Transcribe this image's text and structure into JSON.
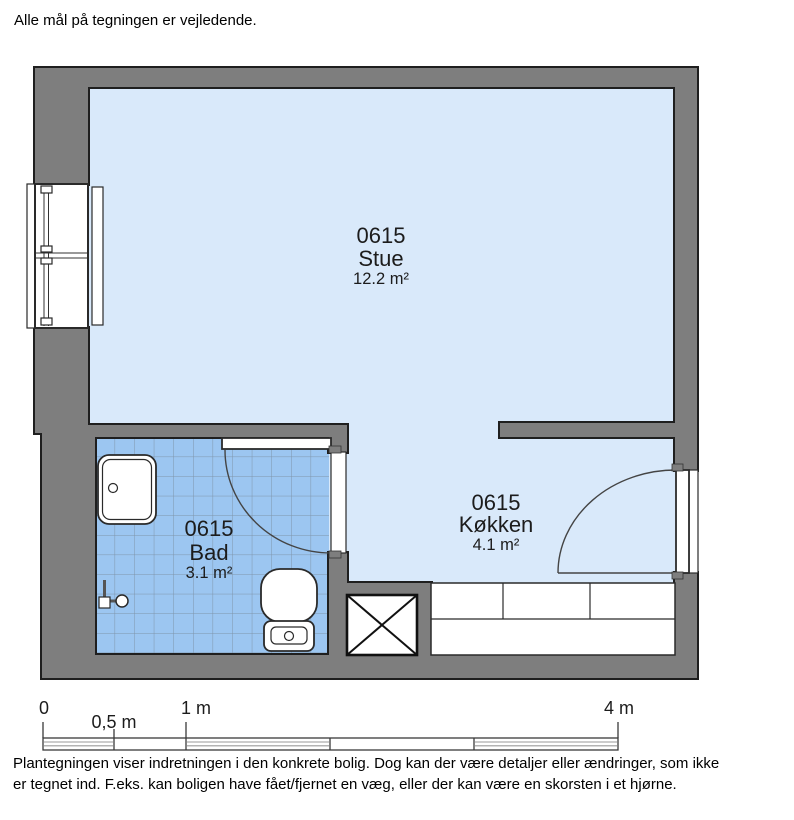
{
  "notes": {
    "top": "Alle mål på tegningen er vejledende.",
    "bottom_line1": "Plantegningen viser indretningen i den konkrete bolig. Dog kan der være detaljer eller ændringer, som ikke",
    "bottom_line2": "er tegnet ind. F.eks. kan boligen have fået/fjernet en væg, eller der kan være en skorsten i et hjørne."
  },
  "floor_plan": {
    "rooms": {
      "stue": {
        "id": "0615",
        "name": "Stue",
        "area": "12.2 m²"
      },
      "bad": {
        "id": "0615",
        "name": "Bad",
        "area": "3.1 m²"
      },
      "kokken": {
        "id": "0615",
        "name": "Køkken",
        "area": "4.1 m²"
      }
    },
    "fixtures": [
      "window",
      "radiator",
      "shower-tray",
      "faucet",
      "toilet",
      "door-swing-bad",
      "door-swing-kokken",
      "vent-shaft",
      "kitchen-counter"
    ]
  },
  "scale_bar": {
    "tick_labels": [
      "0",
      "0,5 m",
      "1 m",
      "4 m"
    ]
  },
  "colors": {
    "wall": "#7e7e7e",
    "wall_outline": "#1f1f1f",
    "room_fill": "#d9e9fa",
    "tile_fill": "#9cc6f1",
    "tile_grid": "#7e94aa",
    "line": "#2a2a2a"
  }
}
